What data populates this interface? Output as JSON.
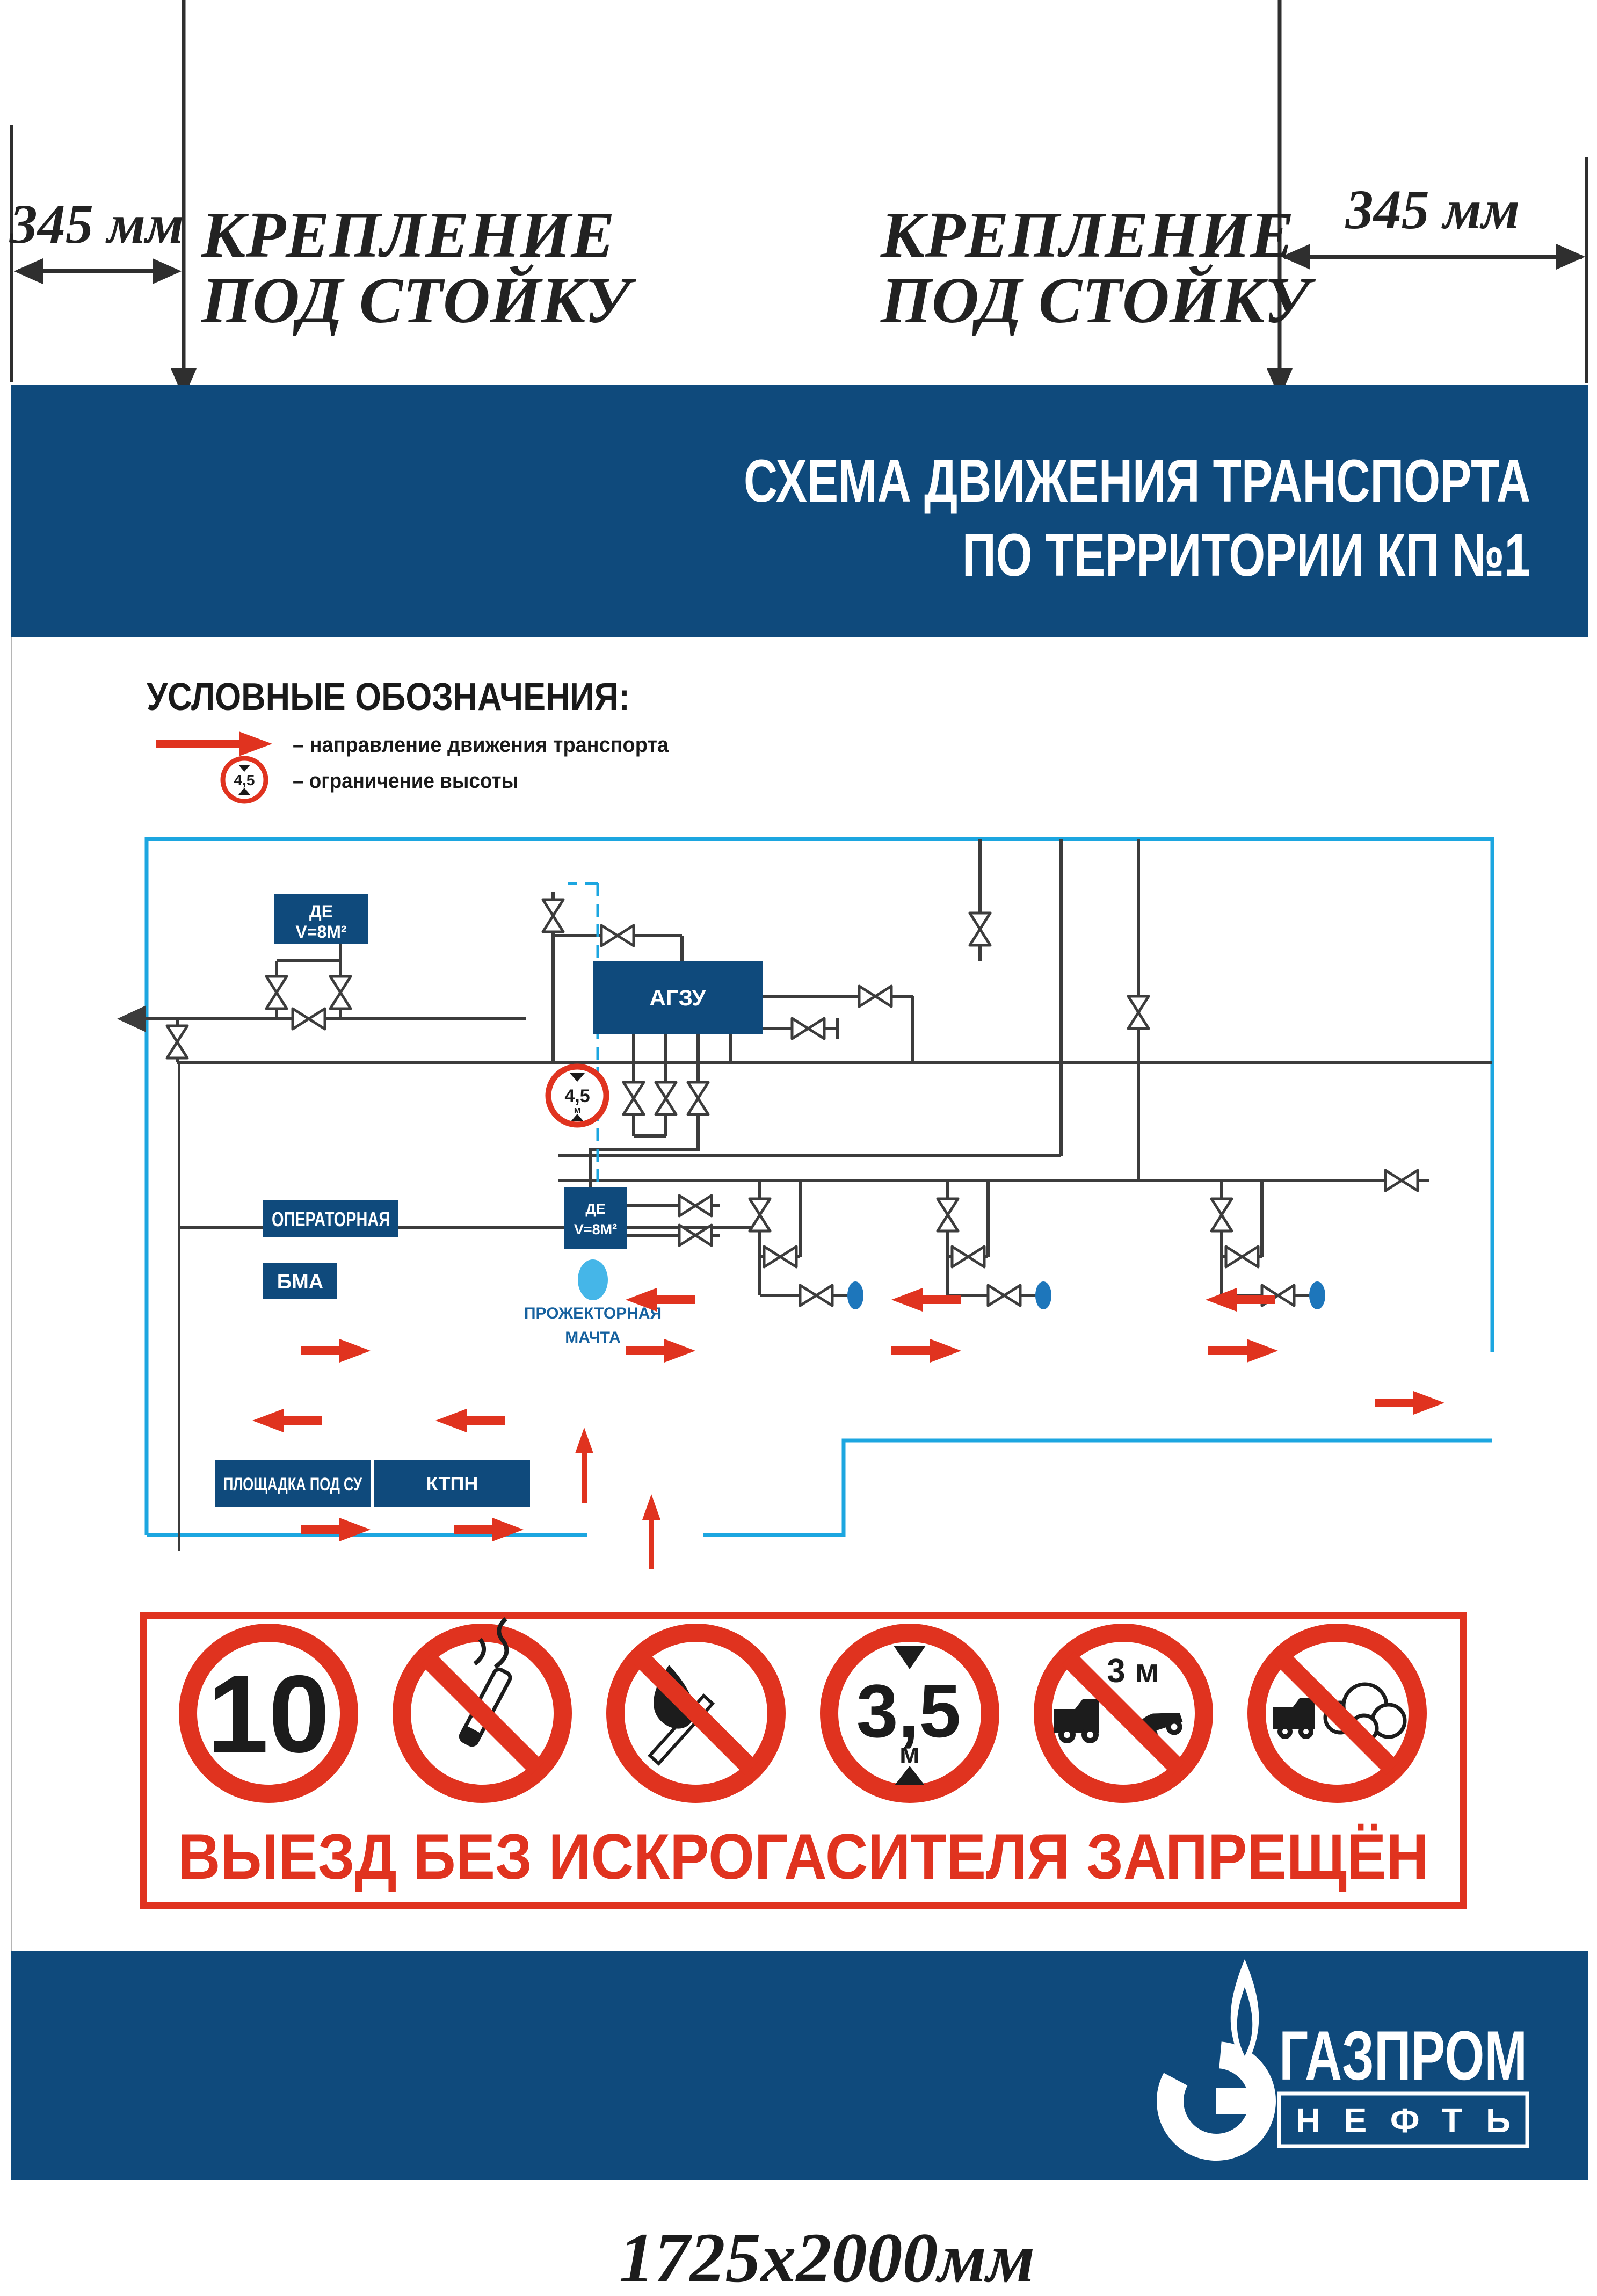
{
  "annotations": {
    "dim_left": "345 мм",
    "dim_right": "345 мм",
    "mount_left": {
      "line1": "КРЕПЛЕНИЕ",
      "line2": "ПОД СТОЙКУ"
    },
    "mount_right": {
      "line1": "КРЕПЛЕНИЕ",
      "line2": "ПОД СТОЙКУ"
    },
    "size_note": "1725х2000мм"
  },
  "header": {
    "title_line1": "СХЕМА ДВИЖЕНИЯ ТРАНСПОРТА",
    "title_line2": "ПО ТЕРРИТОРИИ КП №1"
  },
  "legend": {
    "heading": "УСЛОВНЫЕ ОБОЗНАЧЕНИЯ:",
    "direction_label": "– направление движения транспорта",
    "height_label": "– ограничение высоты",
    "height_sign": {
      "value": "4,5",
      "unit": "м"
    }
  },
  "diagram": {
    "tank_west": {
      "line1": "ДЕ",
      "line2": "V=8М²"
    },
    "agzu": "АГЗУ",
    "operator_room": "ОПЕРАТОРНАЯ",
    "bma": "БМА",
    "tank_center": {
      "line1": "ДЕ",
      "line2": "V=8М²"
    },
    "mast": {
      "line1": "ПРОЖЕКТОРНАЯ",
      "line2": "МАЧТА"
    },
    "pad_su": "ПЛОЩАДКА ПОД СУ",
    "ktpn": "КТПН",
    "height_sign": {
      "value": "4,5",
      "unit": "м"
    }
  },
  "prohibition": {
    "speed_limit": "10",
    "height_limit": {
      "value": "3,5",
      "unit": "м"
    },
    "distance_limit": "3 м",
    "caption": "ВЫЕЗД БЕЗ ИСКРОГАСИТЕЛЯ ЗАПРЕЩЁН"
  },
  "footer": {
    "brand_line1": "ГАЗПРОМ",
    "brand_line2": "НЕФТЬ"
  },
  "colors": {
    "brand_blue": "#0f4a7c",
    "accent_red": "#e0331f",
    "boundary_cyan": "#1ca6e0",
    "mast_blue": "#45b6e8",
    "well_blue": "#1d76bb",
    "pipe_dark": "#3c3c3c"
  }
}
